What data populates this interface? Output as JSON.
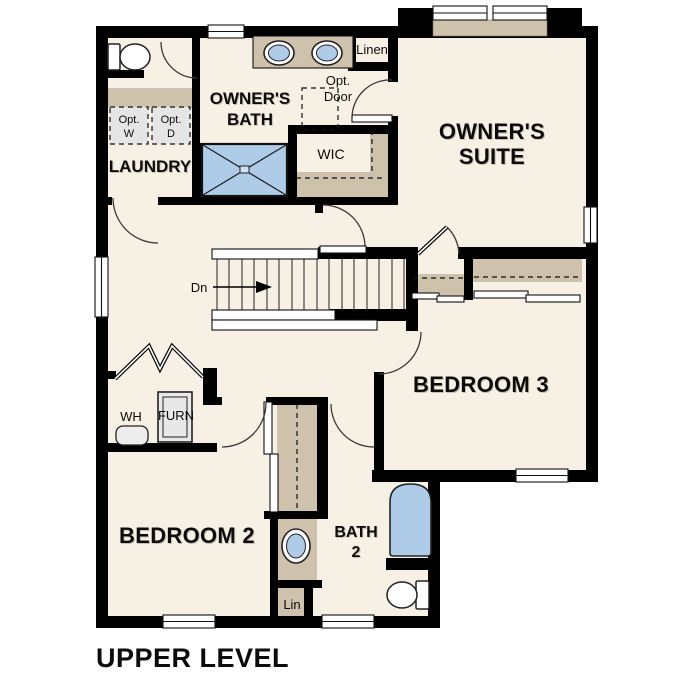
{
  "title": "UPPER LEVEL",
  "rooms": {
    "owners_bath_1": "OWNER'S",
    "owners_bath_2": "BATH",
    "owners_suite_1": "OWNER'S",
    "owners_suite_2": "SUITE",
    "laundry": "LAUNDRY",
    "wic": "WIC",
    "linen": "Linen",
    "bedroom3": "BEDROOM 3",
    "bedroom2": "BEDROOM 2",
    "bath2_1": "BATH",
    "bath2_2": "2",
    "lin": "Lin"
  },
  "annotations": {
    "opt_door_1": "Opt.",
    "opt_door_2": "Door",
    "opt_w_1": "Opt.",
    "opt_w_2": "W",
    "opt_d_1": "Opt.",
    "opt_d_2": "D",
    "wh": "WH",
    "furn": "FURN",
    "stairs_down": "Dn"
  },
  "colors": {
    "floor": "#f7f0e4",
    "wall": "#000000",
    "shelf_tan": "#cec2ac",
    "fixture_blue": "#aecbe8",
    "appliance_gray": "#e5e5e5",
    "arc": "#3a3a3a"
  }
}
